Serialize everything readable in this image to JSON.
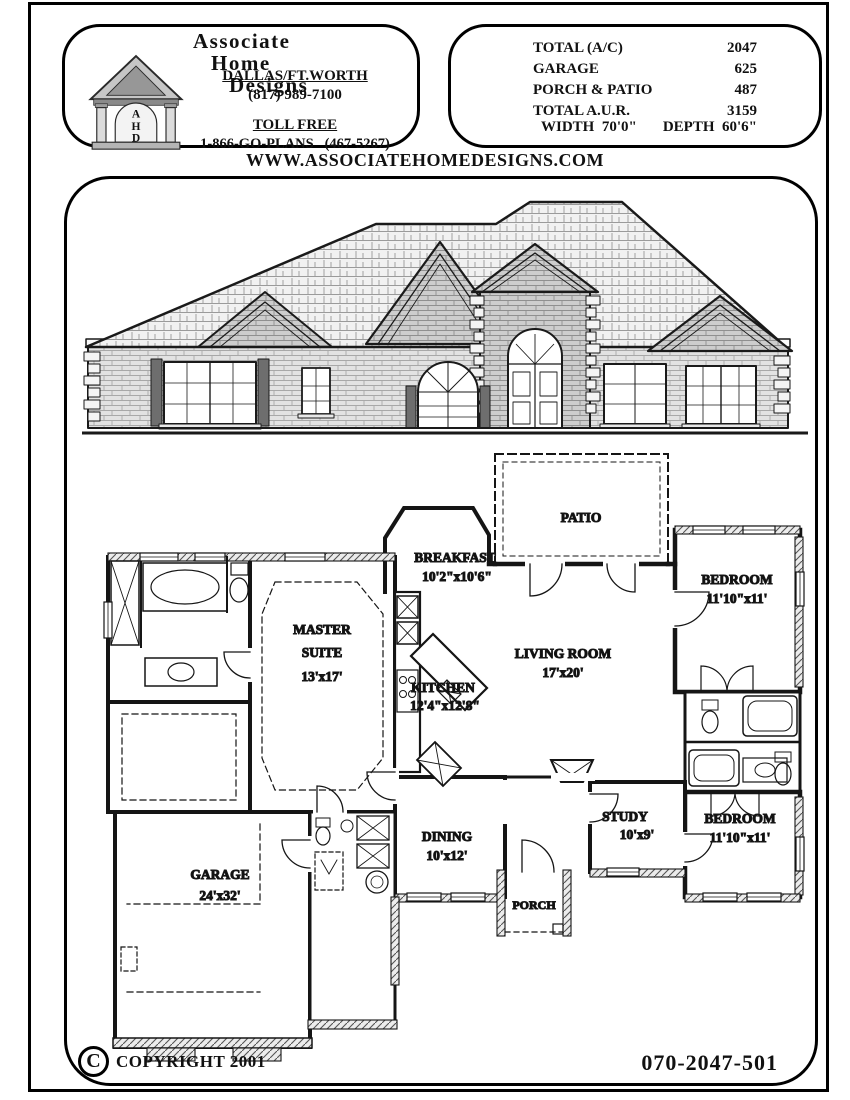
{
  "header": {
    "logo": {
      "name_lines": [
        "Associate",
        "Home",
        "Designs"
      ],
      "letters": [
        "A",
        "H",
        "D"
      ]
    },
    "contact": {
      "region": "DALLAS/FT.WORTH",
      "phone": "(817) 989-7100",
      "toll_free_label": "TOLL FREE",
      "toll_free_number": "1-866-GO-PLANS   (467-5267)"
    },
    "stats": {
      "rows": [
        {
          "label": "TOTAL (A/C)",
          "value": "2047"
        },
        {
          "label": "GARAGE",
          "value": "625"
        },
        {
          "label": "PORCH & PATIO",
          "value": "487"
        },
        {
          "label": "TOTAL A.U.R.",
          "value": "3159"
        }
      ],
      "width": "WIDTH  70'0\"",
      "depth": "DEPTH  60'6\""
    }
  },
  "website": "WWW.ASSOCIATEHOMEDESIGNS.COM",
  "plan": {
    "rooms": [
      {
        "name": "PATIO",
        "dims": ""
      },
      {
        "name": "BREAKFAST",
        "dims": "10'2\"x10'6\""
      },
      {
        "name": "BEDROOM",
        "dims": "11'10\"x11'"
      },
      {
        "name": "MASTER SUITE",
        "name_lines": [
          "MASTER",
          "SUITE"
        ],
        "dims": "13'x17'"
      },
      {
        "name": "KITCHEN",
        "dims": "12'4\"x12'8\""
      },
      {
        "name": "LIVING ROOM",
        "dims": "17'x20'"
      },
      {
        "name": "STUDY",
        "dims": "10'x9'"
      },
      {
        "name": "DINING",
        "dims": "10'x12'"
      },
      {
        "name": "BEDROOM",
        "dims": "11'10\"x11'"
      },
      {
        "name": "GARAGE",
        "dims": "24'x32'"
      },
      {
        "name": "PORCH",
        "dims": ""
      }
    ]
  },
  "footer": {
    "copyright_symbol": "C",
    "copyright": "COPYRIGHT 2001",
    "plan_number": "070-2047-501"
  }
}
